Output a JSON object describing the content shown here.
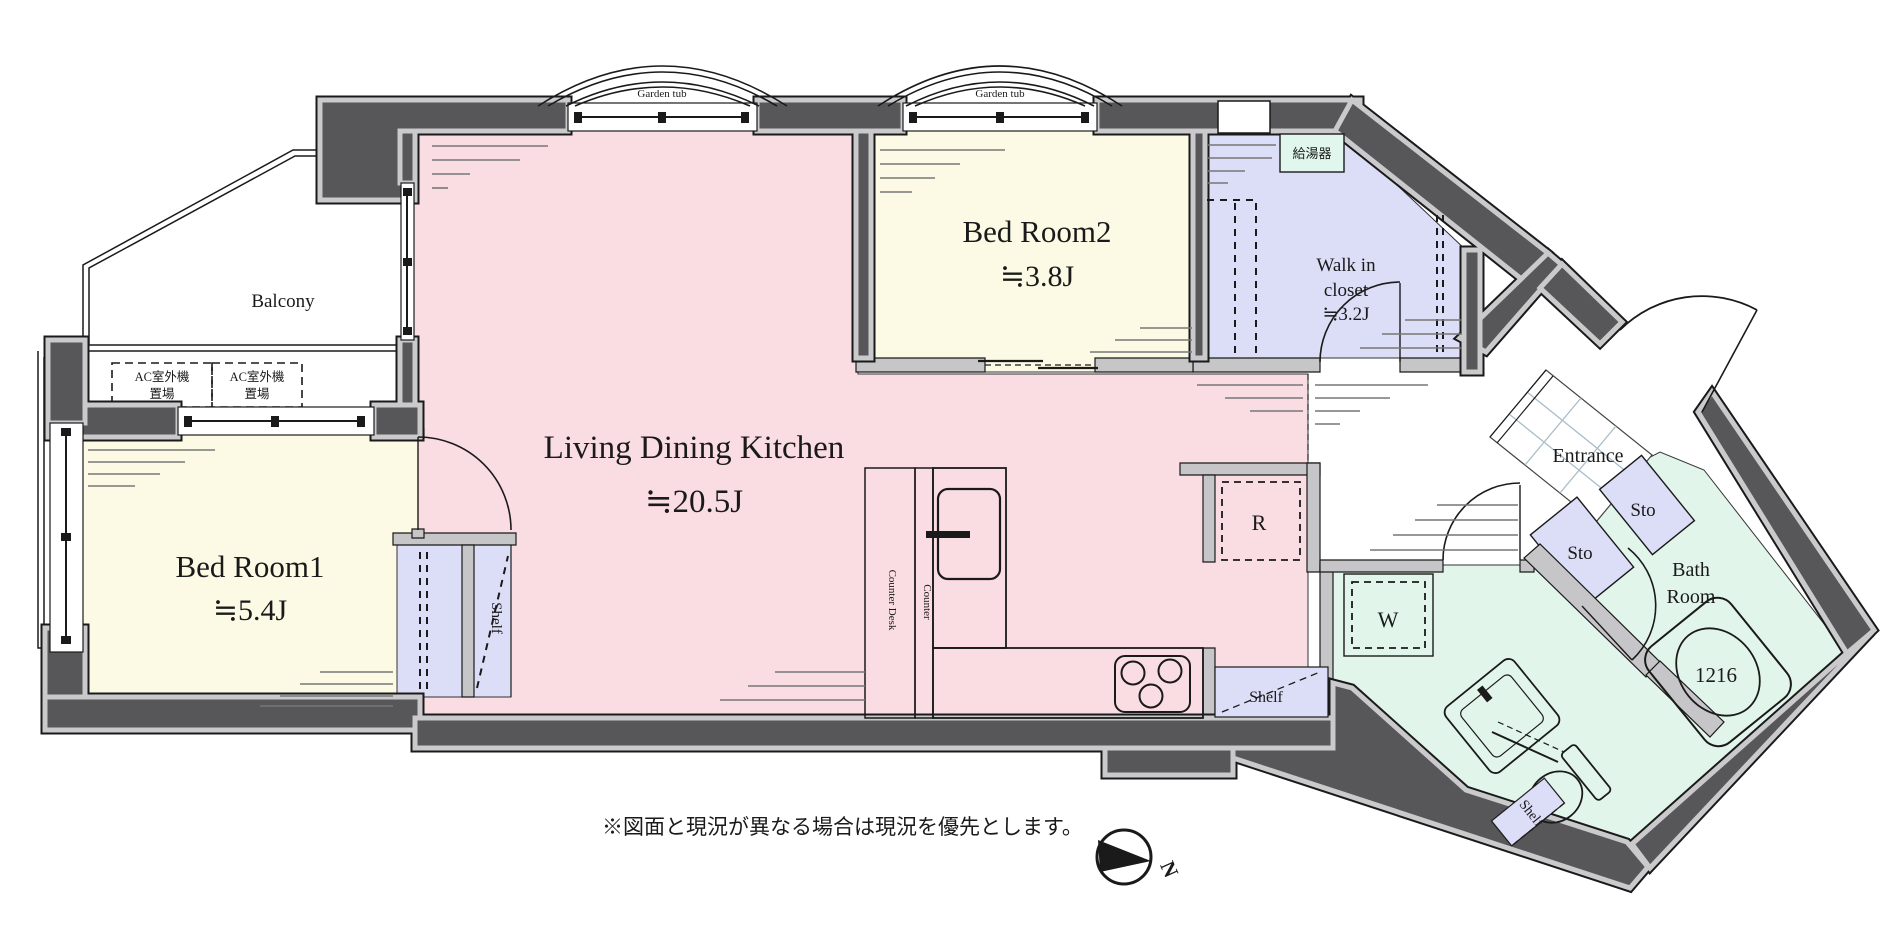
{
  "plan": {
    "rooms": {
      "ldk": {
        "name": "Living Dining Kitchen",
        "size": "≒20.5J"
      },
      "bedroom1": {
        "name": "Bed Room1",
        "size": "≒5.4J"
      },
      "bedroom2": {
        "name": "Bed Room2",
        "size": "≒3.8J"
      },
      "walk_in_closet": {
        "line1": "Walk in",
        "line2": "closet",
        "size": "≒3.2J"
      },
      "balcony": {
        "name": "Balcony"
      },
      "entrance": {
        "name": "Entrance"
      },
      "bathroom": {
        "line1": "Bath",
        "line2": "Room",
        "tub_size": "1216"
      }
    },
    "fixtures": {
      "garden_tub": "Garden tub",
      "ac_outdoor_line1": "AC室外機",
      "ac_outdoor_line2": "置場",
      "water_heater": "給湯器",
      "counter_desk": "Counter Desk",
      "counter": "Counter",
      "refrigerator": "R",
      "washing_machine": "W",
      "shelf": "Shelf",
      "storage": "Sto"
    },
    "compass": {
      "north": "N"
    },
    "notes": {
      "disclaimer": "※図面と現況が異なる場合は現況を優先とします。"
    },
    "colors": {
      "ldk": "#fadde2",
      "bedroom": "#fcfae4",
      "closet": "#dcddf6",
      "wet": "#e1f5eb",
      "wall": "#57575a",
      "partition": "#c6c6c9",
      "tile_line": "#a8bcc9"
    }
  }
}
